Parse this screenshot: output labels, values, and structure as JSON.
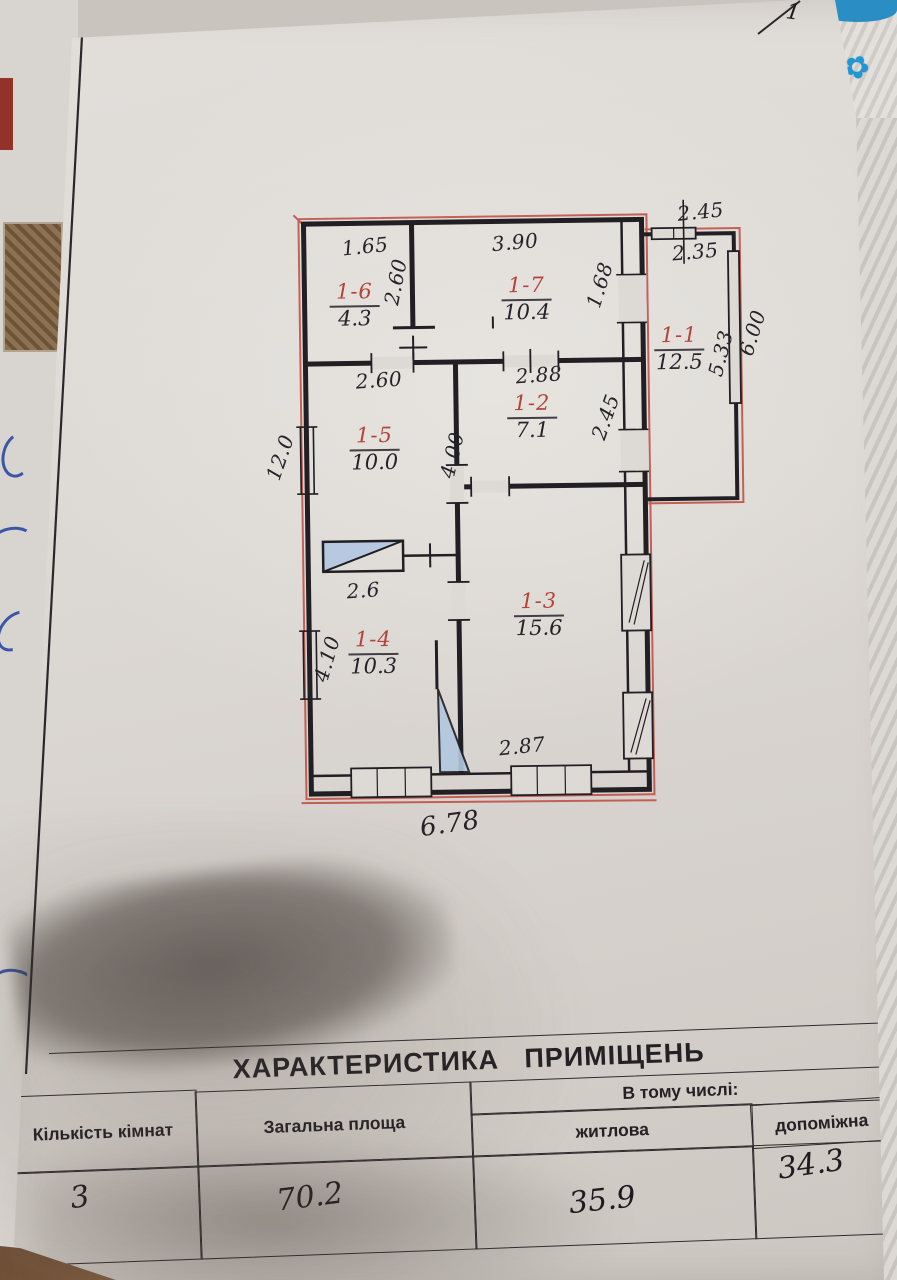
{
  "page": {
    "corner_mark": "1"
  },
  "plan": {
    "rooms": {
      "r11": {
        "id": "1-1",
        "area": "12.5"
      },
      "r12": {
        "id": "1-2",
        "area": "7.1"
      },
      "r13": {
        "id": "1-3",
        "area": "15.6"
      },
      "r14": {
        "id": "1-4",
        "area": "10.3"
      },
      "r15": {
        "id": "1-5",
        "area": "10.0"
      },
      "r16": {
        "id": "1-6",
        "area": "4.3"
      },
      "r17": {
        "id": "1-7",
        "area": "10.4"
      }
    },
    "dims": {
      "w16": "1.65",
      "h16": "2.60",
      "w17": "3.90",
      "door17": "1.68",
      "annex_w_out": "2.45",
      "annex_w_in": "2.35",
      "annex_h_in": "5.33",
      "annex_h_out": "6.00",
      "w15": "2.60",
      "w12": "2.88",
      "h12": "2.45",
      "h15": "4.00",
      "side_left": "12.0",
      "stove": "2.6",
      "h14": "4.10",
      "w13_bottom": "2.87",
      "bottom_total": "6.78"
    }
  },
  "table": {
    "title": "ХАРАКТЕРИСТИКА   ПРИМІЩЕНЬ",
    "col_rooms": "Кількість кімнат",
    "col_total": "Загальна площа",
    "col_including": "В тому числі:",
    "col_living": "житлова",
    "col_aux": "допоміжна",
    "values": {
      "rooms": "3",
      "total": "70.2",
      "living": "35.9",
      "aux": "34.3"
    }
  },
  "colors": {
    "ink": "#211e24",
    "red_pen": "#b5443b",
    "pencil_blue": "#b3c7e0"
  }
}
